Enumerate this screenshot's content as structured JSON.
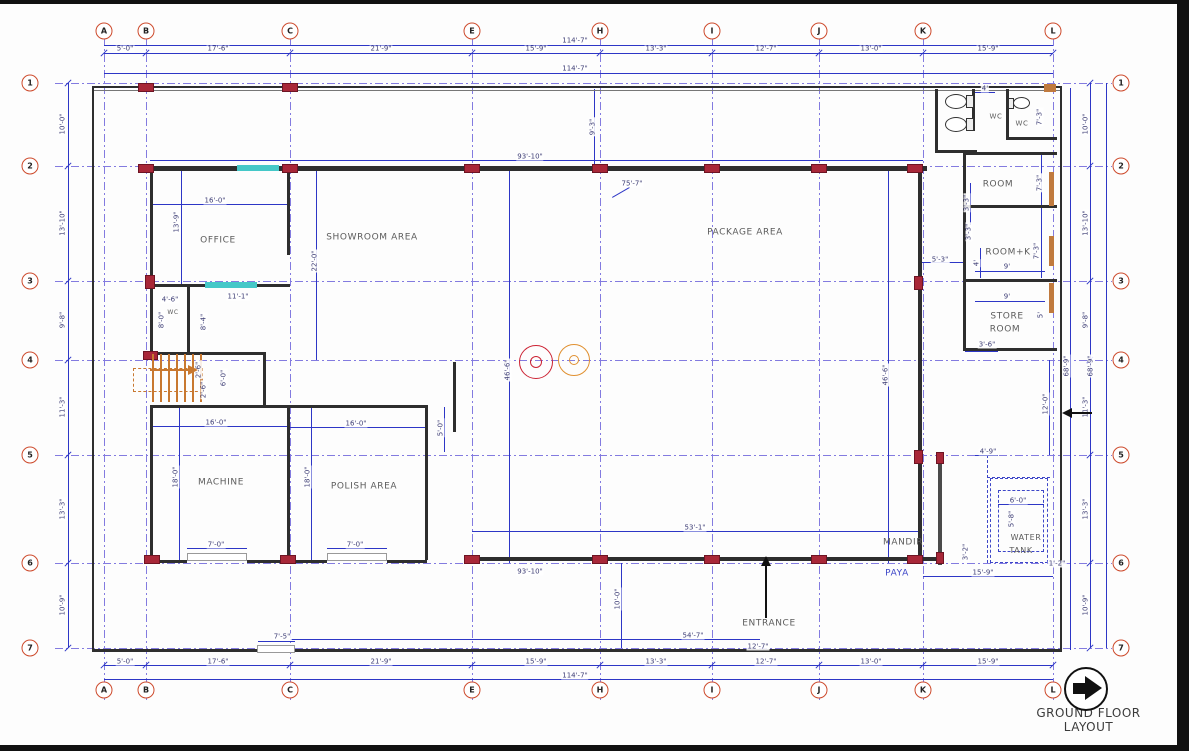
{
  "title": {
    "text": "GROUND FLOOR LAYOUT"
  },
  "colors": {
    "grid": "#837be0",
    "dimension_line": "#2d36c6",
    "dim_text": "#3c3c74",
    "wall": "#2e2e2e",
    "column_marker": "#a82738",
    "window": "#45c8c8",
    "door": "#c07a3e",
    "bubble_ring": "#cd4a2c",
    "stairs": "#c87830",
    "machine_circle_red": "#cc2233",
    "machine_circle_orange": "#e09030"
  },
  "grid": {
    "columns": [
      {
        "label": "A",
        "x": 104
      },
      {
        "label": "B",
        "x": 146
      },
      {
        "label": "C",
        "x": 290
      },
      {
        "label": "E",
        "x": 472
      },
      {
        "label": "H",
        "x": 600
      },
      {
        "label": "I",
        "x": 712
      },
      {
        "label": "J",
        "x": 819
      },
      {
        "label": "K",
        "x": 923
      },
      {
        "label": "L",
        "x": 1053
      }
    ],
    "rows": [
      {
        "label": "1",
        "y": 83
      },
      {
        "label": "2",
        "y": 166
      },
      {
        "label": "3",
        "y": 281
      },
      {
        "label": "4",
        "y": 360
      },
      {
        "label": "5",
        "y": 455
      },
      {
        "label": "6",
        "y": 563
      },
      {
        "label": "7",
        "y": 648
      }
    ],
    "col_dims": [
      {
        "t": "5'-0\"",
        "x": 125
      },
      {
        "t": "17'-6\"",
        "x": 218
      },
      {
        "t": "21'-9\"",
        "x": 381
      },
      {
        "t": "15'-9\"",
        "x": 536
      },
      {
        "t": "13'-3\"",
        "x": 656
      },
      {
        "t": "12'-7\"",
        "x": 766
      },
      {
        "t": "13'-0\"",
        "x": 871
      },
      {
        "t": "15'-9\"",
        "x": 988
      }
    ],
    "row_dims": [
      {
        "t": "10'-0\"",
        "y": 124
      },
      {
        "t": "13'-10\"",
        "y": 223
      },
      {
        "t": "9'-8\"",
        "y": 320
      },
      {
        "t": "11'-3\"",
        "y": 407
      },
      {
        "t": "13'-3\"",
        "y": 509
      },
      {
        "t": "10'-9\"",
        "y": 605
      }
    ],
    "overall_width": "114'-7\"",
    "overall_height": "68'-9\""
  },
  "rooms": [
    {
      "n": "office",
      "t": "OFFICE",
      "x": 218,
      "y": 241
    },
    {
      "n": "showroom-area",
      "t": "SHOWROOM AREA",
      "x": 372,
      "y": 238
    },
    {
      "n": "package-area",
      "t": "PACKAGE  AREA",
      "x": 745,
      "y": 233
    },
    {
      "n": "machine",
      "t": "MACHINE",
      "x": 221,
      "y": 483
    },
    {
      "n": "polish-area",
      "t": "POLISH AREA",
      "x": 364,
      "y": 487
    },
    {
      "n": "room",
      "t": "ROOM",
      "x": 998,
      "y": 185
    },
    {
      "n": "room-kitchen",
      "t": "ROOM+K",
      "x": 1008,
      "y": 253
    },
    {
      "n": "store-room-line1",
      "t": "STORE",
      "x": 1007,
      "y": 317
    },
    {
      "n": "store-room-line2",
      "t": "ROOM",
      "x": 1005,
      "y": 330
    },
    {
      "n": "water-tank-line1",
      "t": "WATER",
      "x": 1026,
      "y": 538,
      "f": 8
    },
    {
      "n": "water-tank-line2",
      "t": "TANK",
      "x": 1021,
      "y": 551,
      "f": 8
    },
    {
      "n": "mandir",
      "t": "MANDIR",
      "x": 903,
      "y": 543
    },
    {
      "n": "paya",
      "t": "PAYA",
      "x": 897,
      "y": 574,
      "c": "#3d46c8"
    },
    {
      "n": "entrance",
      "t": "ENTRANCE",
      "x": 769,
      "y": 624
    },
    {
      "n": "wc-right-1",
      "t": "WC",
      "x": 996,
      "y": 117,
      "f": 7
    },
    {
      "n": "wc-right-2",
      "t": "WC",
      "x": 1022,
      "y": 124,
      "f": 7
    },
    {
      "n": "wc-office",
      "t": "WC",
      "x": 173,
      "y": 313,
      "f": 6
    }
  ],
  "dims": [
    {
      "t": "114'-7\"",
      "x": 575,
      "y": 41
    },
    {
      "t": "114'-7\"",
      "x": 575,
      "y": 69
    },
    {
      "t": "114'-7\"",
      "x": 575,
      "y": 676
    },
    {
      "t": "68'-9\"",
      "x": 1067,
      "y": 366,
      "r": 1
    },
    {
      "t": "68'-9\"",
      "x": 1091,
      "y": 366,
      "r": 1
    },
    {
      "t": "16'-0\"",
      "x": 215,
      "y": 201
    },
    {
      "t": "13'-9\"",
      "x": 177,
      "y": 222,
      "r": 1
    },
    {
      "t": "22'-0\"",
      "x": 315,
      "y": 261,
      "r": 1
    },
    {
      "t": "4'-6\"",
      "x": 170,
      "y": 300
    },
    {
      "t": "11'-1\"",
      "x": 238,
      "y": 297
    },
    {
      "t": "8'-0\"",
      "x": 162,
      "y": 320,
      "r": 1
    },
    {
      "t": "8'-4\"",
      "x": 204,
      "y": 322,
      "r": 1
    },
    {
      "t": "93'-10\"",
      "x": 530,
      "y": 157
    },
    {
      "t": "9'-3\"",
      "x": 593,
      "y": 127,
      "r": 1
    },
    {
      "t": "75'-7\"",
      "x": 632,
      "y": 184
    },
    {
      "t": "46'-6\"",
      "x": 508,
      "y": 370,
      "r": 1
    },
    {
      "t": "46'-6\"",
      "x": 886,
      "y": 375,
      "r": 1
    },
    {
      "t": "5'-3\"",
      "x": 940,
      "y": 260
    },
    {
      "t": "4'",
      "x": 977,
      "y": 263,
      "r": 1
    },
    {
      "t": "7'-3\"",
      "x": 1040,
      "y": 183,
      "r": 1
    },
    {
      "t": "3'-3\"",
      "x": 967,
      "y": 203,
      "r": 1
    },
    {
      "t": "3'-3\"",
      "x": 969,
      "y": 232,
      "r": 1
    },
    {
      "t": "7'-3\"",
      "x": 1037,
      "y": 251,
      "r": 1
    },
    {
      "t": "9'",
      "x": 1007,
      "y": 267
    },
    {
      "t": "9'",
      "x": 1007,
      "y": 297
    },
    {
      "t": "5'",
      "x": 1041,
      "y": 315,
      "r": 1
    },
    {
      "t": "3'-6\"",
      "x": 987,
      "y": 345
    },
    {
      "t": "4'",
      "x": 985,
      "y": 89
    },
    {
      "t": "7'-3\"",
      "x": 1040,
      "y": 117,
      "r": 1
    },
    {
      "t": "16'-0\"",
      "x": 216,
      "y": 423
    },
    {
      "t": "16'-0\"",
      "x": 356,
      "y": 424
    },
    {
      "t": "5'-0\"",
      "x": 441,
      "y": 428,
      "r": 1
    },
    {
      "t": "18'-0\"",
      "x": 176,
      "y": 477,
      "r": 1
    },
    {
      "t": "18'-0\"",
      "x": 308,
      "y": 477,
      "r": 1
    },
    {
      "t": "7'-0\"",
      "x": 216,
      "y": 545
    },
    {
      "t": "7'-0\"",
      "x": 355,
      "y": 545
    },
    {
      "t": "2'-6\"",
      "x": 199,
      "y": 370,
      "r": 1
    },
    {
      "t": "2'-6\"",
      "x": 204,
      "y": 390,
      "r": 1
    },
    {
      "t": "6'-0\"",
      "x": 224,
      "y": 378,
      "r": 1
    },
    {
      "t": "53'-1\"",
      "x": 695,
      "y": 528
    },
    {
      "t": "93'-10\"",
      "x": 530,
      "y": 572
    },
    {
      "t": "10'-0\"",
      "x": 618,
      "y": 599,
      "r": 1
    },
    {
      "t": "54'-7\"",
      "x": 693,
      "y": 636
    },
    {
      "t": "12'-7\"",
      "x": 758,
      "y": 647
    },
    {
      "t": "12'-0\"",
      "x": 1046,
      "y": 404,
      "r": 1
    },
    {
      "t": "4'-9\"",
      "x": 988,
      "y": 452
    },
    {
      "t": "6'-0\"",
      "x": 1018,
      "y": 501
    },
    {
      "t": "5'-8\"",
      "x": 1012,
      "y": 519,
      "r": 1
    },
    {
      "t": "3'-2\"",
      "x": 966,
      "y": 552,
      "r": 1
    },
    {
      "t": "15'-9\"",
      "x": 983,
      "y": 573
    },
    {
      "t": "1'-2\"",
      "x": 1057,
      "y": 564
    },
    {
      "t": "7'-5\"",
      "x": 282,
      "y": 637
    }
  ],
  "lines": [
    {
      "x": 104,
      "y": 45,
      "l": 949
    },
    {
      "x": 104,
      "y": 53,
      "l": 949
    },
    {
      "x": 104,
      "y": 73,
      "l": 949
    },
    {
      "x": 104,
      "y": 665,
      "l": 949
    },
    {
      "x": 104,
      "y": 679,
      "l": 949
    },
    {
      "x": 68,
      "y": 83,
      "l": 565,
      "v": 1
    },
    {
      "x": 1070,
      "y": 88,
      "l": 562,
      "v": 1
    },
    {
      "x": 1090,
      "y": 83,
      "l": 565,
      "v": 1
    },
    {
      "x": 1106,
      "y": 83,
      "l": 565,
      "v": 1
    },
    {
      "x": 152,
      "y": 204,
      "l": 135
    },
    {
      "x": 181,
      "y": 171,
      "l": 113,
      "v": 1
    },
    {
      "x": 316,
      "y": 171,
      "l": 189,
      "v": 1
    },
    {
      "x": 150,
      "y": 160,
      "l": 773
    },
    {
      "x": 594,
      "y": 89,
      "l": 77,
      "v": 1
    },
    {
      "x": 509,
      "y": 167,
      "l": 396,
      "v": 1
    },
    {
      "x": 888,
      "y": 167,
      "l": 396,
      "v": 1
    },
    {
      "x": 920,
      "y": 262,
      "l": 43
    },
    {
      "x": 472,
      "y": 531,
      "l": 450
    },
    {
      "x": 621,
      "y": 563,
      "l": 85,
      "v": 1
    },
    {
      "x": 290,
      "y": 639,
      "l": 470
    },
    {
      "x": 712,
      "y": 650,
      "l": 107
    },
    {
      "x": 152,
      "y": 426,
      "l": 135
    },
    {
      "x": 290,
      "y": 427,
      "l": 136
    },
    {
      "x": 444,
      "y": 407,
      "l": 45,
      "v": 1
    },
    {
      "x": 179,
      "y": 407,
      "l": 153,
      "v": 1
    },
    {
      "x": 311,
      "y": 407,
      "l": 153,
      "v": 1
    },
    {
      "x": 187,
      "y": 548,
      "l": 60
    },
    {
      "x": 327,
      "y": 548,
      "l": 60
    },
    {
      "x": 1049,
      "y": 360,
      "l": 95,
      "v": 1
    },
    {
      "x": 998,
      "y": 504,
      "l": 46
    },
    {
      "x": 923,
      "y": 576,
      "l": 130
    },
    {
      "x": 975,
      "y": 455,
      "l": 23
    },
    {
      "x": 975,
      "y": 92,
      "l": 20
    },
    {
      "x": 1041,
      "y": 152,
      "l": 53,
      "v": 1
    },
    {
      "x": 1041,
      "y": 208,
      "l": 70,
      "v": 1
    },
    {
      "x": 970,
      "y": 183,
      "l": 42,
      "v": 1
    },
    {
      "x": 980,
      "y": 248,
      "l": 30,
      "v": 1
    },
    {
      "x": 975,
      "y": 271,
      "l": 70
    },
    {
      "x": 975,
      "y": 301,
      "l": 70
    },
    {
      "x": 965,
      "y": 351,
      "l": 33
    },
    {
      "x": 258,
      "y": 641,
      "l": 37
    },
    {
      "x": 612,
      "y": 197,
      "l": 20,
      "rot": -30
    },
    {
      "x": 987,
      "y": 455,
      "l": 108,
      "v": 1,
      "d": 1
    },
    {
      "x": 987,
      "y": 477,
      "l": 63,
      "d": 1
    }
  ],
  "walls": [
    {
      "x": 92,
      "y": 86,
      "w": 970,
      "h": 2
    },
    {
      "x": 92,
      "y": 90,
      "w": 970,
      "h": 1,
      "c": "#777"
    },
    {
      "x": 92,
      "y": 86,
      "w": 2,
      "h": 566
    },
    {
      "x": 1060,
      "y": 86,
      "w": 2,
      "h": 566
    },
    {
      "x": 92,
      "y": 649,
      "w": 167,
      "h": 3
    },
    {
      "x": 294,
      "y": 649,
      "w": 768,
      "h": 3
    },
    {
      "x": 140,
      "y": 166,
      "w": 787,
      "h": 5
    },
    {
      "x": 918,
      "y": 171,
      "w": 4,
      "h": 390
    },
    {
      "x": 472,
      "y": 557,
      "w": 450,
      "h": 4
    },
    {
      "x": 922,
      "y": 557,
      "w": 18,
      "h": 4
    },
    {
      "x": 938,
      "y": 455,
      "w": 4,
      "h": 110,
      "c": "#4a4a4a"
    },
    {
      "x": 150,
      "y": 171,
      "w": 3,
      "h": 181
    },
    {
      "x": 150,
      "y": 407,
      "w": 3,
      "h": 153
    },
    {
      "x": 287,
      "y": 171,
      "w": 3,
      "h": 84
    },
    {
      "x": 150,
      "y": 284,
      "w": 140,
      "h": 3
    },
    {
      "x": 187,
      "y": 287,
      "w": 3,
      "h": 65
    },
    {
      "x": 150,
      "y": 352,
      "w": 116,
      "h": 3
    },
    {
      "x": 263,
      "y": 352,
      "w": 3,
      "h": 55
    },
    {
      "x": 150,
      "y": 405,
      "w": 278,
      "h": 3
    },
    {
      "x": 425,
      "y": 405,
      "w": 3,
      "h": 155
    },
    {
      "x": 287,
      "y": 407,
      "w": 3,
      "h": 153
    },
    {
      "x": 453,
      "y": 362,
      "w": 3,
      "h": 70
    },
    {
      "x": 150,
      "y": 560,
      "w": 37,
      "h": 3
    },
    {
      "x": 247,
      "y": 560,
      "w": 80,
      "h": 3
    },
    {
      "x": 387,
      "y": 560,
      "w": 40,
      "h": 3
    },
    {
      "x": 963,
      "y": 152,
      "w": 94,
      "h": 3
    },
    {
      "x": 963,
      "y": 205,
      "w": 94,
      "h": 3
    },
    {
      "x": 963,
      "y": 279,
      "w": 94,
      "h": 3
    },
    {
      "x": 963,
      "y": 348,
      "w": 94,
      "h": 3
    },
    {
      "x": 963,
      "y": 152,
      "w": 3,
      "h": 199
    },
    {
      "x": 935,
      "y": 89,
      "w": 3,
      "h": 64
    },
    {
      "x": 935,
      "y": 150,
      "w": 42,
      "h": 3
    },
    {
      "x": 972,
      "y": 89,
      "w": 3,
      "h": 42
    },
    {
      "x": 1006,
      "y": 89,
      "w": 3,
      "h": 50
    },
    {
      "x": 1006,
      "y": 137,
      "w": 51,
      "h": 3
    }
  ],
  "markers": [
    {
      "x": 138,
      "y": 83,
      "w": 16,
      "h": 9
    },
    {
      "x": 282,
      "y": 83,
      "w": 16,
      "h": 9
    },
    {
      "x": 138,
      "y": 164,
      "w": 16,
      "h": 9
    },
    {
      "x": 282,
      "y": 164,
      "w": 16,
      "h": 9
    },
    {
      "x": 464,
      "y": 164,
      "w": 16,
      "h": 9
    },
    {
      "x": 592,
      "y": 164,
      "w": 16,
      "h": 9
    },
    {
      "x": 704,
      "y": 164,
      "w": 16,
      "h": 9
    },
    {
      "x": 811,
      "y": 164,
      "w": 16,
      "h": 9
    },
    {
      "x": 907,
      "y": 164,
      "w": 16,
      "h": 9
    },
    {
      "x": 464,
      "y": 555,
      "w": 16,
      "h": 9
    },
    {
      "x": 592,
      "y": 555,
      "w": 16,
      "h": 9
    },
    {
      "x": 704,
      "y": 555,
      "w": 16,
      "h": 9
    },
    {
      "x": 811,
      "y": 555,
      "w": 16,
      "h": 9
    },
    {
      "x": 907,
      "y": 555,
      "w": 16,
      "h": 9
    },
    {
      "x": 144,
      "y": 555,
      "w": 16,
      "h": 9
    },
    {
      "x": 280,
      "y": 555,
      "w": 16,
      "h": 9
    },
    {
      "x": 145,
      "y": 275,
      "w": 10,
      "h": 14
    },
    {
      "x": 143,
      "y": 351,
      "w": 15,
      "h": 9
    },
    {
      "x": 914,
      "y": 276,
      "w": 9,
      "h": 14
    },
    {
      "x": 914,
      "y": 450,
      "w": 9,
      "h": 14
    },
    {
      "x": 936,
      "y": 452,
      "w": 8,
      "h": 12
    },
    {
      "x": 936,
      "y": 552,
      "w": 8,
      "h": 12
    }
  ],
  "windows": [
    {
      "x": 237,
      "y": 165,
      "w": 42,
      "h": 6
    },
    {
      "x": 205,
      "y": 282,
      "w": 52,
      "h": 6
    }
  ],
  "doors": [
    {
      "x": 1044,
      "y": 84,
      "w": 12,
      "h": 8
    },
    {
      "x": 1049,
      "y": 172,
      "w": 5,
      "h": 34
    },
    {
      "x": 1049,
      "y": 236,
      "w": 5,
      "h": 30
    },
    {
      "x": 1049,
      "y": 283,
      "w": 5,
      "h": 30
    }
  ],
  "openings": [
    {
      "x": 187,
      "y": 553,
      "w": 60,
      "h": 8
    },
    {
      "x": 327,
      "y": 553,
      "w": 60,
      "h": 8
    },
    {
      "x": 257,
      "y": 645,
      "w": 38,
      "h": 8
    }
  ],
  "dashed_rects": [
    {
      "x": 990,
      "y": 478,
      "w": 58,
      "h": 85
    },
    {
      "x": 998,
      "y": 490,
      "w": 46,
      "h": 62
    }
  ],
  "circles": [
    {
      "x": 536,
      "y": 362,
      "r": 17,
      "ri": 6,
      "c": "#cc2233"
    },
    {
      "x": 574,
      "y": 360,
      "r": 16,
      "ri": 5,
      "c": "#e09030"
    }
  ],
  "toilets": [
    {
      "x": 945,
      "y": 94,
      "w": 22,
      "h": 15
    },
    {
      "x": 945,
      "y": 117,
      "w": 22,
      "h": 15
    },
    {
      "x": 1013,
      "y": 97,
      "w": 17,
      "h": 12
    }
  ],
  "tanks": [
    {
      "x": 966,
      "y": 95,
      "w": 8,
      "h": 13
    },
    {
      "x": 966,
      "y": 118,
      "w": 8,
      "h": 13
    },
    {
      "x": 1008,
      "y": 98,
      "w": 6,
      "h": 11
    }
  ],
  "stairs": {
    "box": {
      "x": 133,
      "y": 368,
      "w": 70,
      "h": 24
    },
    "treads": {
      "x0": 152,
      "step": 8,
      "n": 7,
      "y": 354,
      "h": 48
    }
  },
  "arrows": [
    {
      "n": "entrance-arrow",
      "dir": "up",
      "hx": 765,
      "hy": 556,
      "len": 62,
      "c": "#111"
    },
    {
      "n": "west-arrow",
      "dir": "left",
      "hx": 1062,
      "hy": 412,
      "len": 30,
      "c": "#111"
    },
    {
      "n": "stairs-direction-arrow",
      "dir": "right",
      "hx": 196,
      "hy": 369,
      "len": 46,
      "c": "#c87830"
    }
  ],
  "north_icon": {
    "cx": 1086,
    "cy": 689,
    "r": 22
  }
}
